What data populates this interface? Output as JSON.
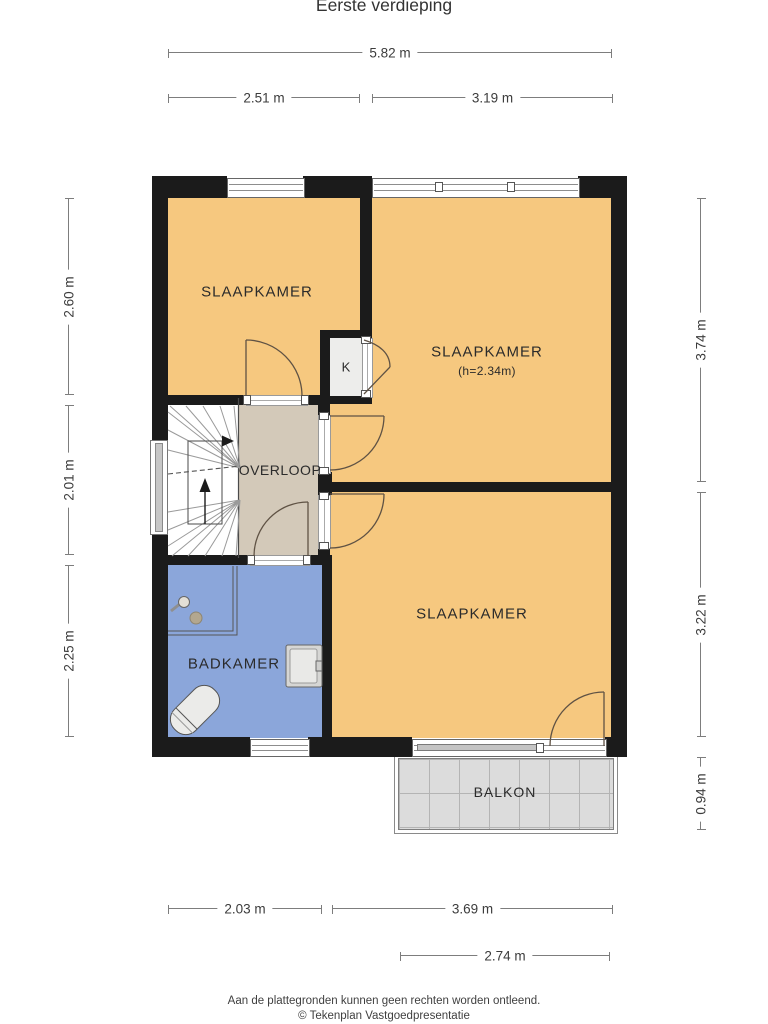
{
  "title": "Eerste verdieping",
  "rooms": {
    "bedroom_top_left": "SLAAPKAMER",
    "bedroom_top_right": "SLAAPKAMER",
    "bedroom_top_right_height": "(h=2.34m)",
    "bedroom_bottom": "SLAAPKAMER",
    "landing": "OVERLOOP",
    "bathroom": "BADKAMER",
    "closet": "K",
    "balcony": "BALKON"
  },
  "dimensions": {
    "top_total": "5.82 m",
    "top_left_room": "2.51 m",
    "top_right_room": "3.19 m",
    "left_top": "2.60 m",
    "left_middle": "2.01 m",
    "left_bottom": "2.25 m",
    "right_top": "3.74 m",
    "right_middle": "3.22 m",
    "right_balcony": "0.94 m",
    "bottom_left_room": "2.03 m",
    "bottom_right_room": "3.69 m",
    "bottom_balcony": "2.74 m"
  },
  "footer": {
    "disclaimer": "Aan de plattegronden kunnen geen rechten worden ontleend.",
    "credit": "© Tekenplan Vastgoedpresentatie"
  },
  "colors": {
    "wall": "#1b1b1b",
    "room": "#f6c87f",
    "bathroom": "#8ba6da",
    "landing": "#d3c9b9",
    "balcony": "#dcdcdc"
  }
}
